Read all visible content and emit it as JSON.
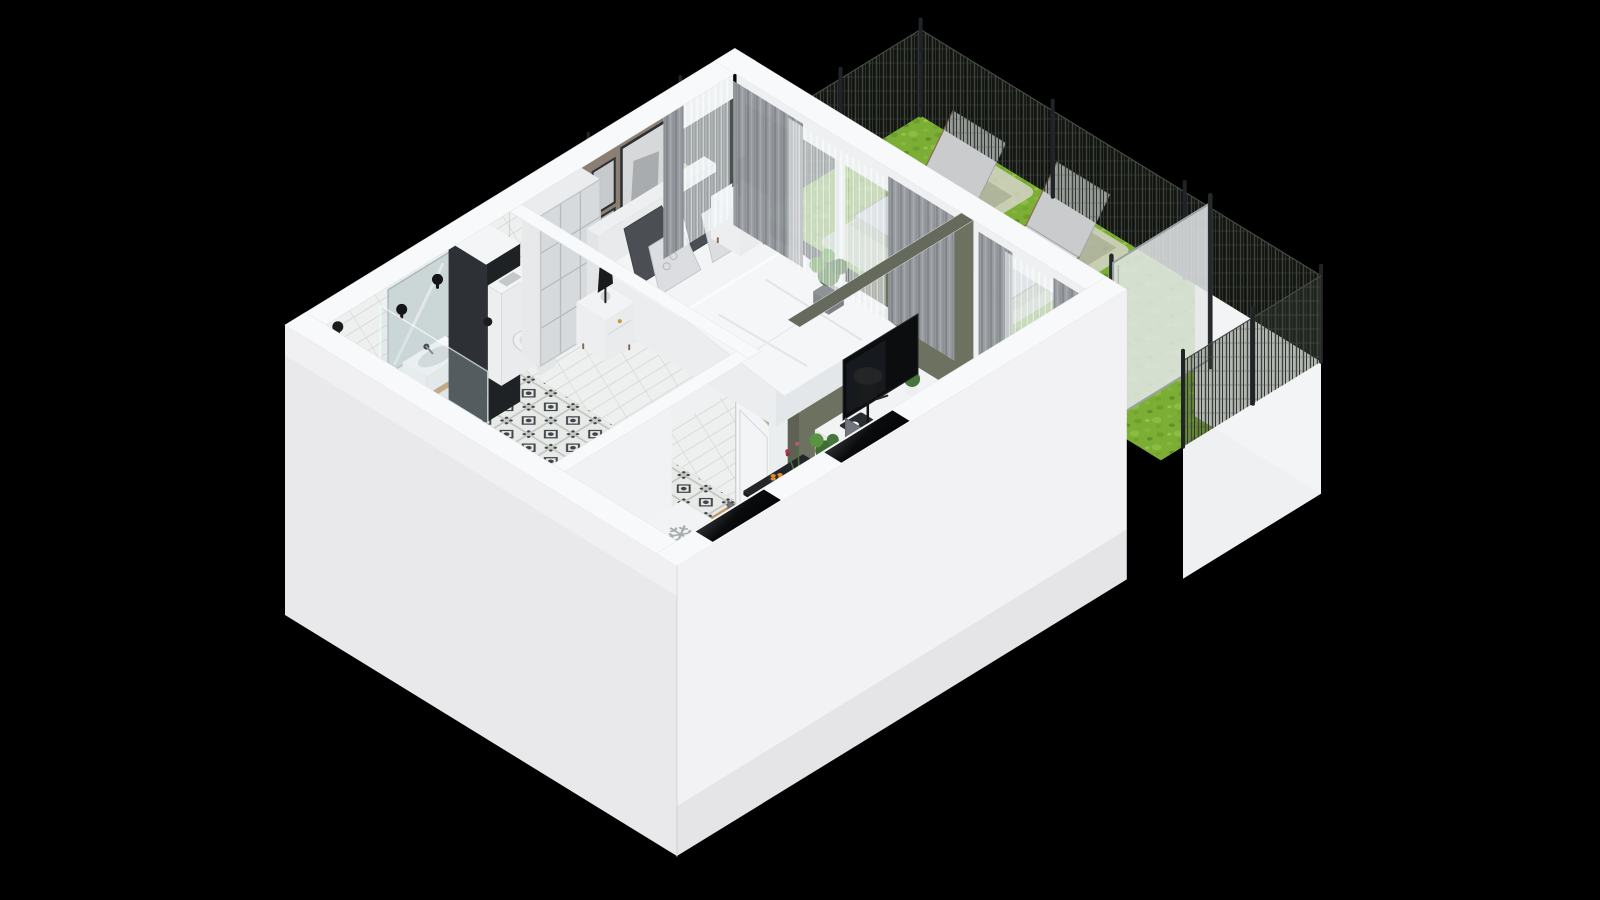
{
  "scene": {
    "type": "isometric-3d-floor-plan",
    "description": "Photorealistic isometric 3D floor plan render of a studio apartment with bathroom, bedroom, living room, kitchen hallway and a fenced garden terrace, on a black background",
    "background": "#000000"
  },
  "palette": {
    "background": "#000000",
    "wall_top": "#f8f9fa",
    "wall_outer_sw": "#e9e9eb",
    "wall_outer_se": "#f2f2f4",
    "wall_inner_white": "#eff1f2",
    "tile_wall": "#edf0ef",
    "taupe_wall": "#8b7e73",
    "olive_wall": "#6d7160",
    "olive_wall_top": "#666a5c",
    "wood_floor": "#c49767",
    "plank_line": "#a97f52",
    "bath_tile_base": "#e8eae7",
    "bath_tile_motif": "#3f4449",
    "dark_column": "#2d3135",
    "dark_column_side": "#1f2225",
    "glass": "rgba(198,209,213,0.42)",
    "curtain_gray": "#95999e",
    "sheer_white": "rgba(242,245,247,0.5)",
    "grass": "#7cae35",
    "gravel": "#d8d5cd",
    "fence_mesh": "#383e36",
    "fence_post": "#202428",
    "frosted_screen": "rgba(228,231,233,0.86)",
    "sofa": "#8d8a7f",
    "rug_living": "#cfc9bc",
    "rug_bedroom": "#e3e4e5",
    "table_black": "#232528",
    "chair_gray": "#7d8187",
    "bed_white": "#f2f4f6",
    "pillow_dark": "#4b4e53",
    "pillow_light": "#dbdde0",
    "appliance_black": "#17181a",
    "counter_wood": "#c49767",
    "plant_green": "#47763a",
    "plant_light": "#5a9443",
    "pot_gray": "#8e9296",
    "lamp_black": "#1a1b1d",
    "tv_black": "#0c0d0f",
    "orange_accent": "#df8c2f",
    "snowflake_gray": "#a7acaf"
  },
  "rooms": {
    "bathroom": {
      "label": "bathroom",
      "furniture": [
        "shower",
        "shower-glass",
        "vanity-sink",
        "mirror",
        "wall-sconces",
        "toilet",
        "duct-column",
        "towel",
        "patterned-tile-floor"
      ]
    },
    "hallway": {
      "label": "hallway",
      "furniture": [
        "entrance-door",
        "bathroom-door",
        "open-wardrobe",
        "freezer-box"
      ]
    },
    "kitchen": {
      "label": "kitchen",
      "furniture": [
        "counter",
        "cooktop",
        "kitchen-sink",
        "window-openings",
        "dining-table",
        "dining-chairs",
        "wood-bench"
      ]
    },
    "bedroom": {
      "label": "bedroom",
      "furniture": [
        "double-bed",
        "pillows",
        "wardrobe",
        "nightstands",
        "table-lamps",
        "wall-pictures",
        "rug",
        "plant",
        "curtains"
      ]
    },
    "living-room": {
      "label": "living-room",
      "furniture": [
        "tv-sideboard",
        "tv",
        "floor-lamp",
        "coffee-table",
        "rug",
        "sofa",
        "plants",
        "curtains"
      ]
    },
    "garden": {
      "label": "garden-terrace",
      "features": [
        "lawn",
        "mesh-fence",
        "fence-posts",
        "sun-loungers",
        "gravel-strips",
        "frosted-privacy-screen",
        "white-plinth"
      ]
    }
  },
  "icons": {
    "freezer_snowflake": "❄"
  }
}
